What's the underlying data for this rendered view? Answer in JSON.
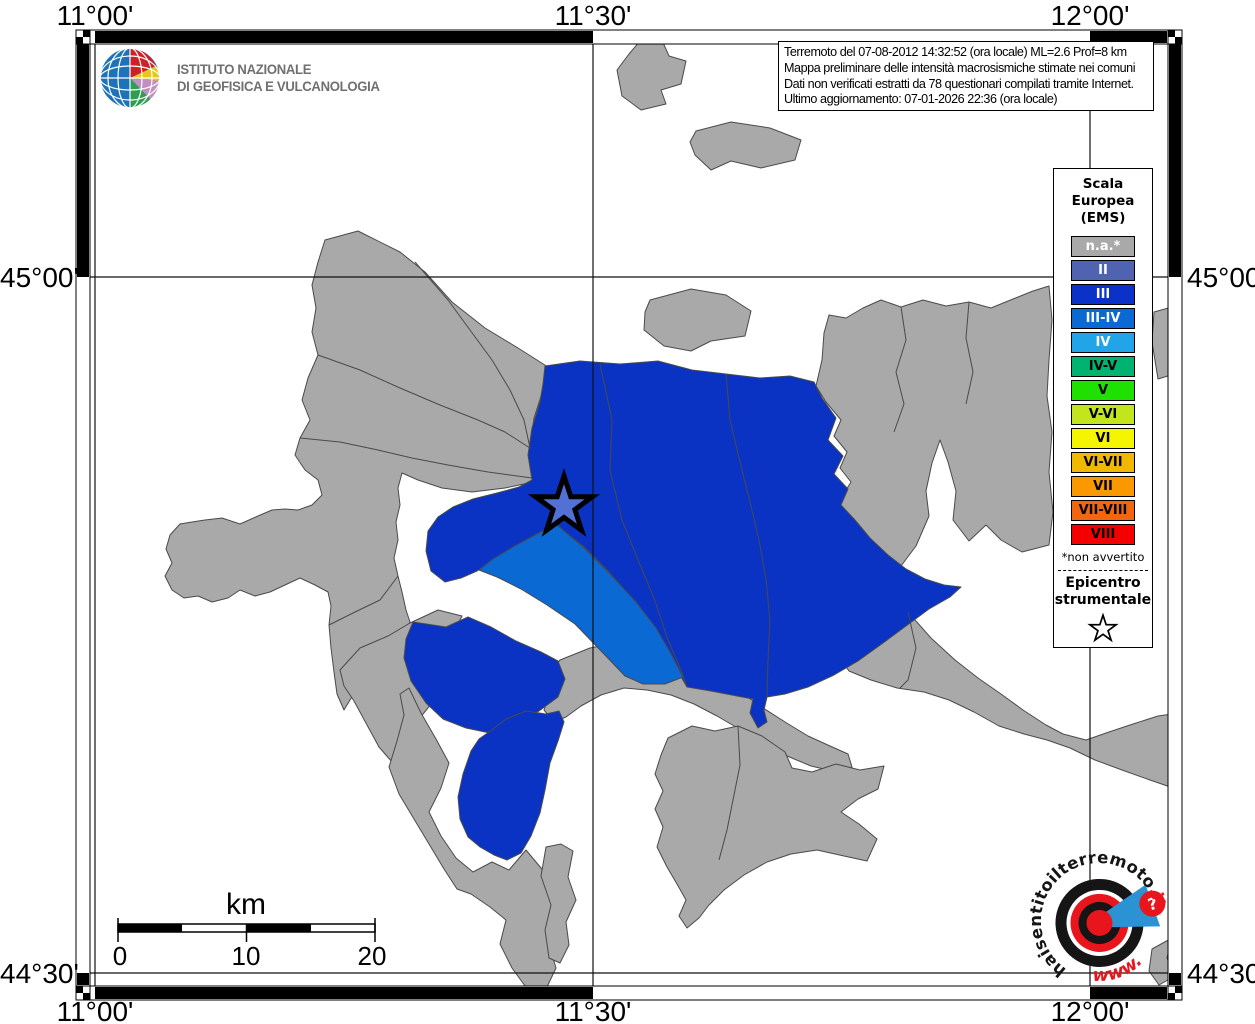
{
  "header": {
    "ingv": {
      "logo": "ingv-globe",
      "name_line1": "ISTITUTO NAZIONALE",
      "name_line2": "DI GEOFISICA E VULCANOLOGIA"
    }
  },
  "info_box": {
    "lines": [
      "Terremoto del 07-08-2012 14:32:52 (ora locale) ML=2.6 Prof=8 km",
      "Mappa preliminare delle intensità macrosismiche stimate nei comuni",
      "Dati non verificati estratti da 78 questionari compilati tramite Internet.",
      "Ultimo aggiornamento: 07-01-2026 22:36 (ora locale)"
    ]
  },
  "legend": {
    "title_lines": [
      "Scala",
      "Europea",
      "(EMS)"
    ],
    "items": [
      {
        "label": "n.a.*",
        "color": "#a9a9a9",
        "text_color": "#ffffff"
      },
      {
        "label": "II",
        "color": "#4f63b0",
        "text_color": "#ffffff"
      },
      {
        "label": "III",
        "color": "#0a32c8",
        "text_color": "#ffffff"
      },
      {
        "label": "III-IV",
        "color": "#0a69d2",
        "text_color": "#ffffff"
      },
      {
        "label": "IV",
        "color": "#22a5e8",
        "text_color": "#ffffff"
      },
      {
        "label": "IV-V",
        "color": "#00b371",
        "text_color": "#000000"
      },
      {
        "label": "V",
        "color": "#1ee100",
        "text_color": "#000000"
      },
      {
        "label": "V-VI",
        "color": "#c2e51e",
        "text_color": "#000000"
      },
      {
        "label": "VI",
        "color": "#f5f500",
        "text_color": "#000000"
      },
      {
        "label": "VI-VII",
        "color": "#f0b800",
        "text_color": "#000000"
      },
      {
        "label": "VII",
        "color": "#fa9800",
        "text_color": "#000000"
      },
      {
        "label": "VII-VIII",
        "color": "#f2670e",
        "text_color": "#000000"
      },
      {
        "label": "VIII",
        "color": "#f50000",
        "text_color": "#000000"
      }
    ],
    "footnote": "*non avvertito",
    "epicenter_lines": [
      "Epicentro",
      "strumentale"
    ],
    "epicenter_symbol": "white-star-black-outline"
  },
  "map": {
    "grid": {
      "lon_labels": [
        "11°00'",
        "11°30'",
        "12°00'"
      ],
      "lat_labels": [
        "45°00'",
        "44°30'"
      ]
    },
    "scale_bar": {
      "title": "km",
      "tick_labels": [
        "0",
        "10",
        "20"
      ]
    },
    "epicenter": {
      "symbol": "star"
    },
    "colors": {
      "unclassified": "#a9a9a9",
      "intensity_III": "#0a33c4",
      "intensity_III_IV": "#0a69d2",
      "boundary": "#4a4a4a"
    }
  },
  "footer_logo": {
    "text_main": "haisentitoilterremoto",
    "text_suffix": ".it",
    "text_www": "www.",
    "question_mark": "?"
  }
}
